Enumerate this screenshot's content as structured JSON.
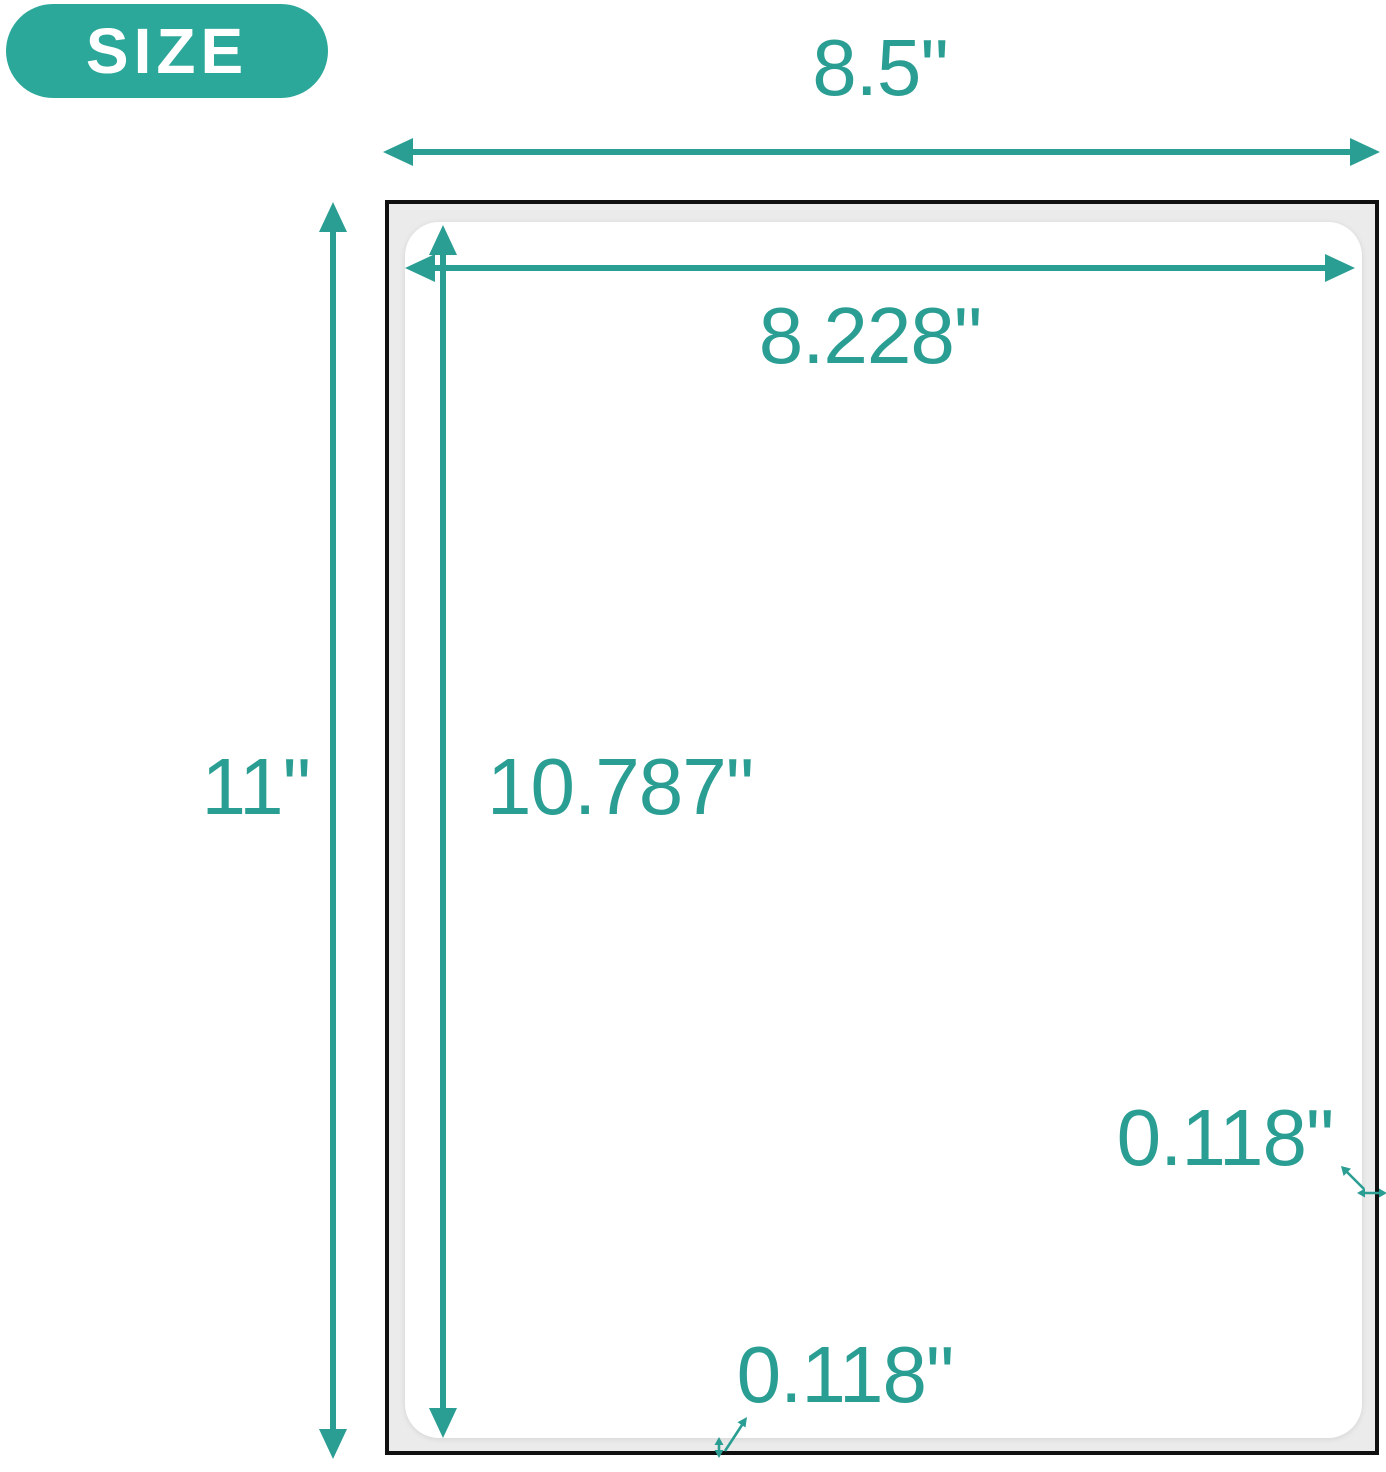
{
  "badge": {
    "label": "SIZE"
  },
  "measurements": {
    "paper_width": "8.5\"",
    "label_width": "8.228\"",
    "paper_height": "11\"",
    "label_height": "10.787\"",
    "side_margin": "0.118\"",
    "bottom_margin": "0.118\""
  },
  "colors": {
    "accent_teal": "#2B9E93",
    "badge_teal": "#2CA89A",
    "sheet_border_black": "#101010",
    "margin_gray": "#EBEBEB",
    "sheet_white": "#FFFFFF",
    "badge_text": "#FFFFFF"
  }
}
